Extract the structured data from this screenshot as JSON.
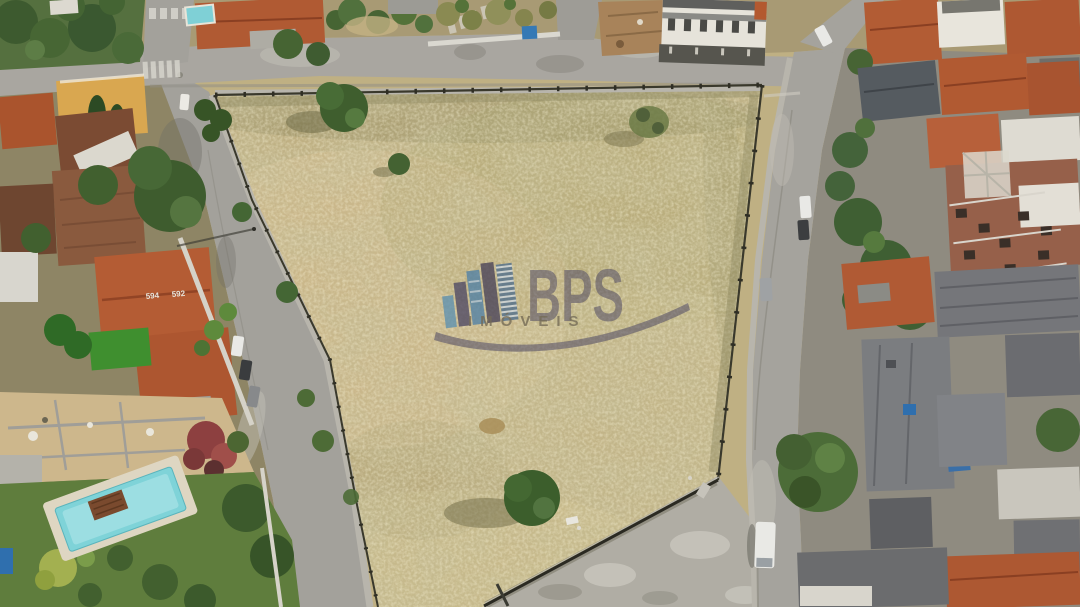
{
  "watermark": {
    "brand": "BPS",
    "subtitle": "IMÓVEIS",
    "icon": "city-skyline-buildings-icon",
    "brand_color": "#4b4663",
    "building_blue_light": "#5b8fb0",
    "building_blue_mid": "#4e7fa6",
    "building_dark": "#454057",
    "subtitle_color": "#6b6350"
  },
  "scene": {
    "type": "aerial-drone-photo",
    "subject": "large vacant dry-grass corner lot fenced on all sides, surrounded by streets, houses with terracotta and corrugated roofs, gardens and swimming pools",
    "house_numbers": [
      "594",
      "592"
    ],
    "palette": {
      "dry_grass": "#c2b183",
      "grass_shadow": "#8b855c",
      "asphalt": "#a3a09a",
      "roof_orange": "#b15a32",
      "roof_gray": "#75767a",
      "roof_brown": "#8a5a3e",
      "tree_green": "#44633a",
      "lawn_green": "#5f7d3d",
      "pool_water": "#7fd3d8",
      "sand": "#cdb78c",
      "brick": "#96604a",
      "white_wall": "#e6e3da"
    }
  }
}
